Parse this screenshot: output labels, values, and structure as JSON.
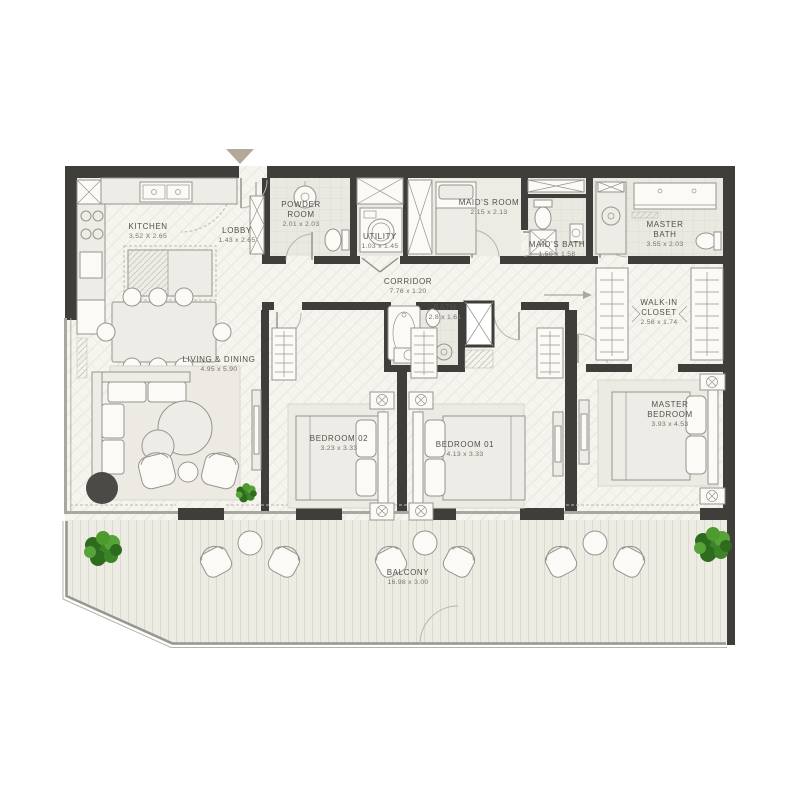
{
  "plan_title": "apartment-floor-plan",
  "colors": {
    "wall": "#3f3e3a",
    "floor": "#f5f4ee",
    "tile_room": "#e9e8e1",
    "balcony_floor": "#edece4",
    "furniture_fill": "#edece6",
    "furniture_stroke": "#96958d",
    "label": "#52514a",
    "dims": "#75746b",
    "plant_dark": "#2f6b1e",
    "plant_light": "#4d9b2e",
    "entry_arrow": "#b2a99a",
    "accent_dark": "#4b4a47",
    "door": "#b5b3aa",
    "window_line": "#a8a7a0"
  },
  "icons": {
    "entry_marker": "entry-arrow-down",
    "corridor_arrow": "arrow-right",
    "lobby_arrow": "arrow-down"
  },
  "rooms": {
    "kitchen": {
      "name": "KITCHEN",
      "dims": "3.52 X 2.65"
    },
    "lobby": {
      "name": "LOBBY",
      "dims": "1.43 x 2.65"
    },
    "powder_room": {
      "name": "POWDER ROOM",
      "dims": "2.01 x 2.03"
    },
    "utility": {
      "name": "UTILITY",
      "dims": "1.03 x 1.45"
    },
    "maids_room": {
      "name": "MAID'S ROOM",
      "dims": "2.15 x 2.13"
    },
    "maids_bath": {
      "name": "MAID'S BATH",
      "dims": "1.50 x 1.58"
    },
    "master_bath": {
      "name": "MASTER BATH",
      "dims": "3.55 x 2.03"
    },
    "corridor": {
      "name": "CORRIDOR",
      "dims": "7.76 x 1.20"
    },
    "walk_in_closet": {
      "name": "WALK-IN CLOSET",
      "dims": "2.58 x 1.74"
    },
    "bath": {
      "name": "BATH",
      "dims": "2.8 x 1.61"
    },
    "living_dining": {
      "name": "LIVING & DINING",
      "dims": "4.95 x 5.90"
    },
    "bedroom_02": {
      "name": "BEDROOM 02",
      "dims": "3.23 x 3.33"
    },
    "bedroom_01": {
      "name": "BEDROOM 01",
      "dims": "4.13 x 3.33"
    },
    "master_bedroom": {
      "name": "MASTER BEDROOM",
      "dims": "3.93 x 4.53"
    },
    "balcony": {
      "name": "BALCONY",
      "dims": "16.98 x 3.00"
    }
  }
}
